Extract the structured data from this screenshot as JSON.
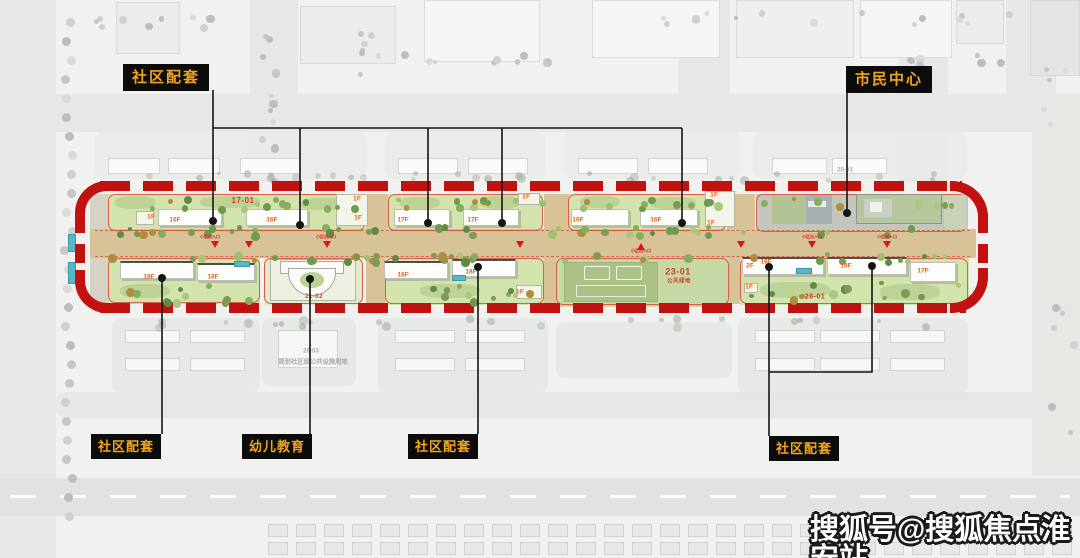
{
  "callouts": [
    {
      "id": "community-top",
      "label": "社区配套"
    },
    {
      "id": "civic-center",
      "label": "市民中心"
    },
    {
      "id": "community-bottom-1",
      "label": "社区配套"
    },
    {
      "id": "kindergarten",
      "label": "幼儿教育"
    },
    {
      "id": "community-bottom-2",
      "label": "社区配套"
    },
    {
      "id": "community-bottom-3",
      "label": "社区配套"
    }
  ],
  "watermark": {
    "text": "搜狐号@搜狐焦点淮安站"
  },
  "plan": {
    "floor_labels": [
      {
        "t": "1F",
        "x": 151,
        "y": 217
      },
      {
        "t": "16F",
        "x": 175,
        "y": 220
      },
      {
        "t": "16F",
        "x": 272,
        "y": 220
      },
      {
        "t": "1F",
        "x": 357,
        "y": 199
      },
      {
        "t": "1F",
        "x": 358,
        "y": 218
      },
      {
        "t": "17F",
        "x": 403,
        "y": 220
      },
      {
        "t": "17F",
        "x": 473,
        "y": 220
      },
      {
        "t": "1F",
        "x": 526,
        "y": 197
      },
      {
        "t": "16F",
        "x": 578,
        "y": 220
      },
      {
        "t": "16F",
        "x": 656,
        "y": 220
      },
      {
        "t": "1F",
        "x": 714,
        "y": 195
      },
      {
        "t": "1F",
        "x": 711,
        "y": 223
      },
      {
        "t": "18F",
        "x": 149,
        "y": 277
      },
      {
        "t": "18F",
        "x": 213,
        "y": 277
      },
      {
        "t": "18F",
        "x": 403,
        "y": 275
      },
      {
        "t": "18F",
        "x": 471,
        "y": 272
      },
      {
        "t": "1F",
        "x": 520,
        "y": 292
      },
      {
        "t": "2F",
        "x": 750,
        "y": 266
      },
      {
        "t": "18F",
        "x": 766,
        "y": 262
      },
      {
        "t": "18F",
        "x": 846,
        "y": 266
      },
      {
        "t": "17F",
        "x": 923,
        "y": 271
      },
      {
        "t": "1F",
        "x": 749,
        "y": 287
      }
    ],
    "plot_labels": [
      {
        "t": "17-01",
        "x": 243,
        "y": 201,
        "s": 8
      },
      {
        "t": "21-02",
        "x": 314,
        "y": 297,
        "s": 6
      },
      {
        "t": "23-01",
        "x": 678,
        "y": 272,
        "s": 9
      },
      {
        "t": "公共绿地",
        "x": 679,
        "y": 282,
        "s": 5.5
      },
      {
        "t": "26-01",
        "x": 815,
        "y": 297,
        "s": 7
      }
    ],
    "ghost_labels": [
      {
        "t": "20-01",
        "x": 845,
        "y": 170
      },
      {
        "t": "26-03",
        "x": 311,
        "y": 351
      },
      {
        "t": "规划社区级公共设施用地",
        "x": 313,
        "y": 362
      }
    ],
    "entrance_labels": [
      {
        "t": "小区出入口",
        "x": 210,
        "y": 237
      },
      {
        "t": "小区出入口",
        "x": 326,
        "y": 237
      },
      {
        "t": "小区出入口",
        "x": 641,
        "y": 251
      },
      {
        "t": "小区出入口",
        "x": 812,
        "y": 237
      },
      {
        "t": "小区出入口",
        "x": 887,
        "y": 237
      }
    ]
  },
  "colors": {
    "boundary_red": "#c11212",
    "callout_bg": "#0c0c0c",
    "callout_text": "#f2a51c",
    "road_tan": "#d8c399",
    "lawn_green": "#d3e3ae",
    "field_green": "#c6d8a4"
  }
}
